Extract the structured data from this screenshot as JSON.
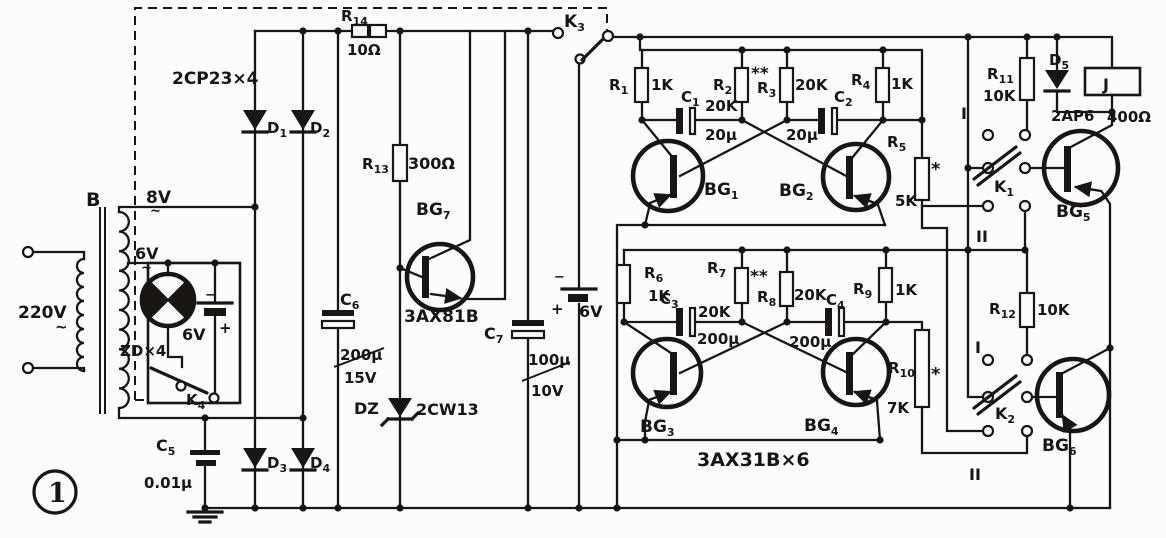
{
  "figure": {
    "number": "1"
  },
  "colors": {
    "ink": "#181512",
    "paper": "#fcfcfa"
  },
  "power_supply": {
    "transformer": "B",
    "mains_voltage": "220V",
    "mains_ac": "~",
    "tap_8v": "8V",
    "tap_8v_ac": "~",
    "tap_6v": "6V",
    "tap_6v_ac": "~",
    "lamp": "ZD×4",
    "battery_left": {
      "minus": "−",
      "plus": "+",
      "value": "6V"
    },
    "k4": {
      "t": "K",
      "s": "4"
    },
    "c5": {
      "t": "C",
      "s": "5"
    },
    "c5_value": "0.01μ",
    "rectifier_type": "2CP23×4",
    "d1": {
      "t": "D",
      "s": "1"
    },
    "d2": {
      "t": "D",
      "s": "2"
    },
    "d3": {
      "t": "D",
      "s": "3"
    },
    "d4": {
      "t": "D",
      "s": "4"
    },
    "r14": {
      "t": "R",
      "s": "14"
    },
    "r14_value": "10Ω",
    "r13": {
      "t": "R",
      "s": "13"
    },
    "r13_value": "300Ω",
    "c6": {
      "t": "C",
      "s": "6"
    },
    "c6_value": "200μ",
    "c6_voltage": "15V",
    "bg7": {
      "t": "BG",
      "s": "7"
    },
    "bg7_type": "3AX81B",
    "dz": "DZ",
    "dz_type": "2CW13",
    "c7": {
      "t": "C",
      "s": "7"
    },
    "c7_value": "100μ",
    "c7_voltage": "10V",
    "battery_right": {
      "minus": "−",
      "plus": "+",
      "value": "6V"
    },
    "k3": {
      "t": "K",
      "s": "3"
    }
  },
  "oscillator_upper": {
    "r1": {
      "t": "R",
      "s": "1"
    },
    "r1_value": "1K",
    "c1": {
      "t": "C",
      "s": "1"
    },
    "c1_value": "20μ",
    "r2": {
      "t": "R",
      "s": "2"
    },
    "r2_value": "20K",
    "r3": {
      "t": "R",
      "s": "3"
    },
    "r3_value": "20K",
    "r3_mark": "**",
    "c2": {
      "t": "C",
      "s": "2"
    },
    "c2_value": "20μ",
    "r4": {
      "t": "R",
      "s": "4"
    },
    "r4_value": "1K",
    "r5": {
      "t": "R",
      "s": "5"
    },
    "r5_value": "5K",
    "r5_mark": "*",
    "bg1": {
      "t": "BG",
      "s": "1"
    },
    "bg2": {
      "t": "BG",
      "s": "2"
    }
  },
  "oscillator_lower": {
    "r6": {
      "t": "R",
      "s": "6"
    },
    "r6_value": "1K",
    "c3": {
      "t": "C",
      "s": "3"
    },
    "c3_value": "200μ",
    "r7": {
      "t": "R",
      "s": "7"
    },
    "r7_value": "20K",
    "r7_mark": "**",
    "r8": {
      "t": "R",
      "s": "8"
    },
    "r8_value": "20K",
    "c4": {
      "t": "C",
      "s": "4"
    },
    "c4_value": "200μ",
    "r9": {
      "t": "R",
      "s": "9"
    },
    "r9_value": "1K",
    "r10": {
      "t": "R",
      "s": "10"
    },
    "r10_value": "7K",
    "r10_mark": "*",
    "bg3": {
      "t": "BG",
      "s": "3"
    },
    "bg4": {
      "t": "BG",
      "s": "4"
    },
    "transistor_type": "3AX31B×6"
  },
  "output_stage": {
    "r11": {
      "t": "R",
      "s": "11"
    },
    "r11_value": "10K",
    "d5": {
      "t": "D",
      "s": "5"
    },
    "d5_type": "2AP6",
    "relay": "J",
    "relay_value": "400Ω",
    "k1": {
      "t": "K",
      "s": "1"
    },
    "k1_pos_i": "I",
    "k1_pos_ii": "II",
    "bg5": {
      "t": "BG",
      "s": "5"
    },
    "r12": {
      "t": "R",
      "s": "12"
    },
    "r12_value": "10K",
    "k2": {
      "t": "K",
      "s": "2"
    },
    "k2_pos_i": "I",
    "k2_pos_ii": "II",
    "bg6": {
      "t": "BG",
      "s": "6"
    }
  }
}
